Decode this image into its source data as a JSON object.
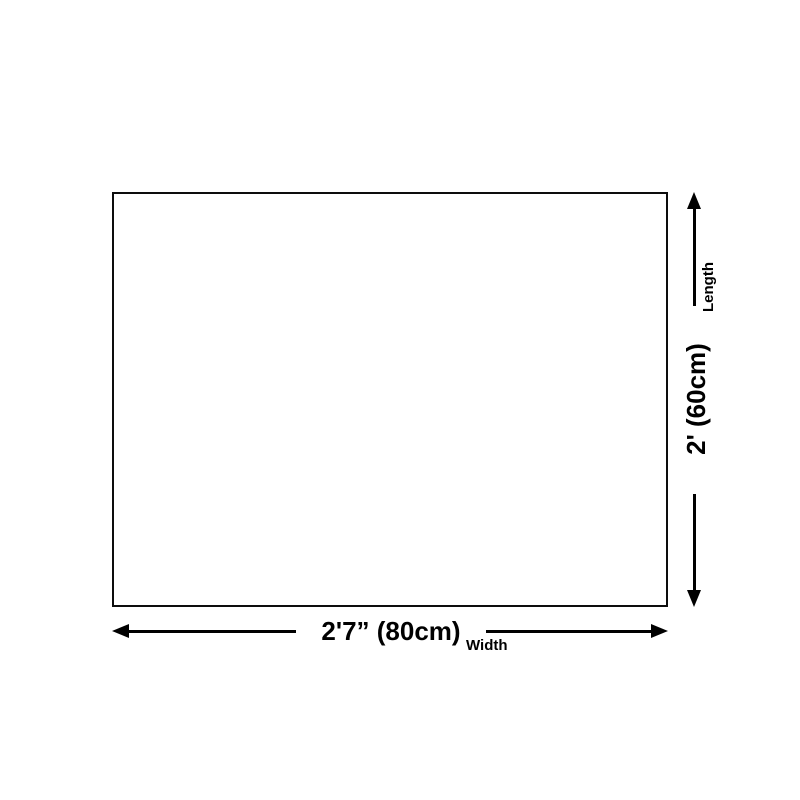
{
  "diagram": {
    "title": "product-dimension-diagram",
    "width_dimension": {
      "value": "2'7” (80cm)",
      "label": "Width"
    },
    "length_dimension": {
      "value": "2' (60cm)",
      "label": "Length"
    },
    "colors": {
      "line": "#000000",
      "outline": "#0d0d0d",
      "background": "#ffffff"
    }
  }
}
